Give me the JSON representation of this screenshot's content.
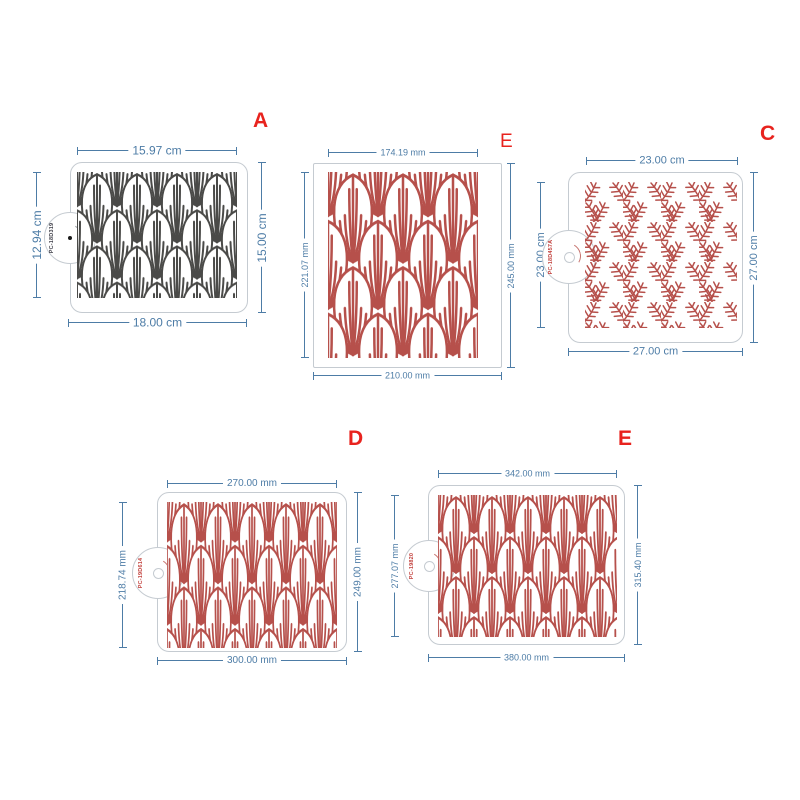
{
  "colors": {
    "dimension_blue": "#4d7ca6",
    "label_red": "#e8231e",
    "pattern_red": "#b6504b",
    "pattern_dark": "#4a4a48",
    "frame_gray": "#c5cbd1"
  },
  "stencils": [
    {
      "letter": "A",
      "code": "PC-18D319",
      "pattern": "palmette-dark",
      "dims": {
        "top": "15.97 cm",
        "left": "12.94 cm",
        "right": "15.00 cm",
        "bottom": "18.00 cm"
      }
    },
    {
      "letter": "E",
      "code": "",
      "pattern": "palmette-red",
      "dims": {
        "top": "174.19 mm",
        "left": "221.07 mm",
        "right": "245.00 mm",
        "bottom": "210.00 mm"
      }
    },
    {
      "letter": "C",
      "code": "PC-18D457A",
      "pattern": "fern-red",
      "dims": {
        "top": "23.00 cm",
        "left": "23.00 cm",
        "right": "27.00 cm",
        "bottom": "27.00 cm"
      }
    },
    {
      "letter": "D",
      "code": "PC-19D614",
      "pattern": "palmette-red",
      "dims": {
        "top": "270.00 mm",
        "left": "218.74 mm",
        "right": "249.00 mm",
        "bottom": "300.00 mm"
      }
    },
    {
      "letter": "E",
      "code": "PC-19820",
      "pattern": "palmette-red",
      "dims": {
        "top": "342.00 mm",
        "left": "277.07 mm",
        "right": "315.40 mm",
        "bottom": "380.00 mm"
      }
    }
  ]
}
